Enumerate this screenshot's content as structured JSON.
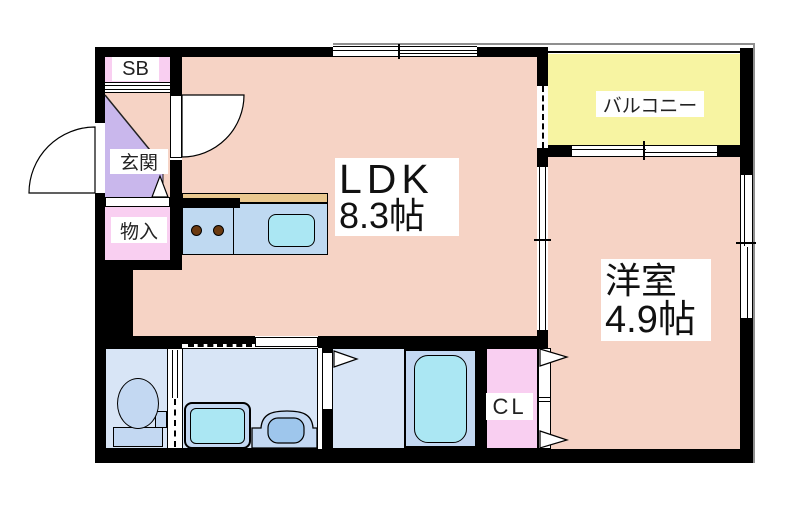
{
  "title": "1LDK apartment floor plan",
  "rooms": {
    "ldk": {
      "name": "LDK",
      "size": "8.3帖"
    },
    "western": {
      "name": "洋室",
      "size": "4.9帖"
    },
    "balcony": {
      "name": "バルコニー"
    },
    "entrance": {
      "name": "玄関"
    },
    "shoebox": {
      "name": "SB"
    },
    "storage": {
      "name": "物入"
    },
    "closet": {
      "name": "CL"
    }
  },
  "colors": {
    "wall": "#000000",
    "floor_pink": "#F6D3C5",
    "balcony_yellow": "#F7F4A2",
    "storage_pink": "#F9CFF1",
    "entrance_purple": "#C9B7EC",
    "wet_blue": "#D8E5F6",
    "fixture_blue": "#C3D8F2",
    "water_cyan": "#ABE7F3",
    "counter_blue": "#BFD9F1",
    "counter_tan": "#EAC88F",
    "burner_brown": "#6B3A10",
    "shadow_gray": "#8F8F8F"
  }
}
